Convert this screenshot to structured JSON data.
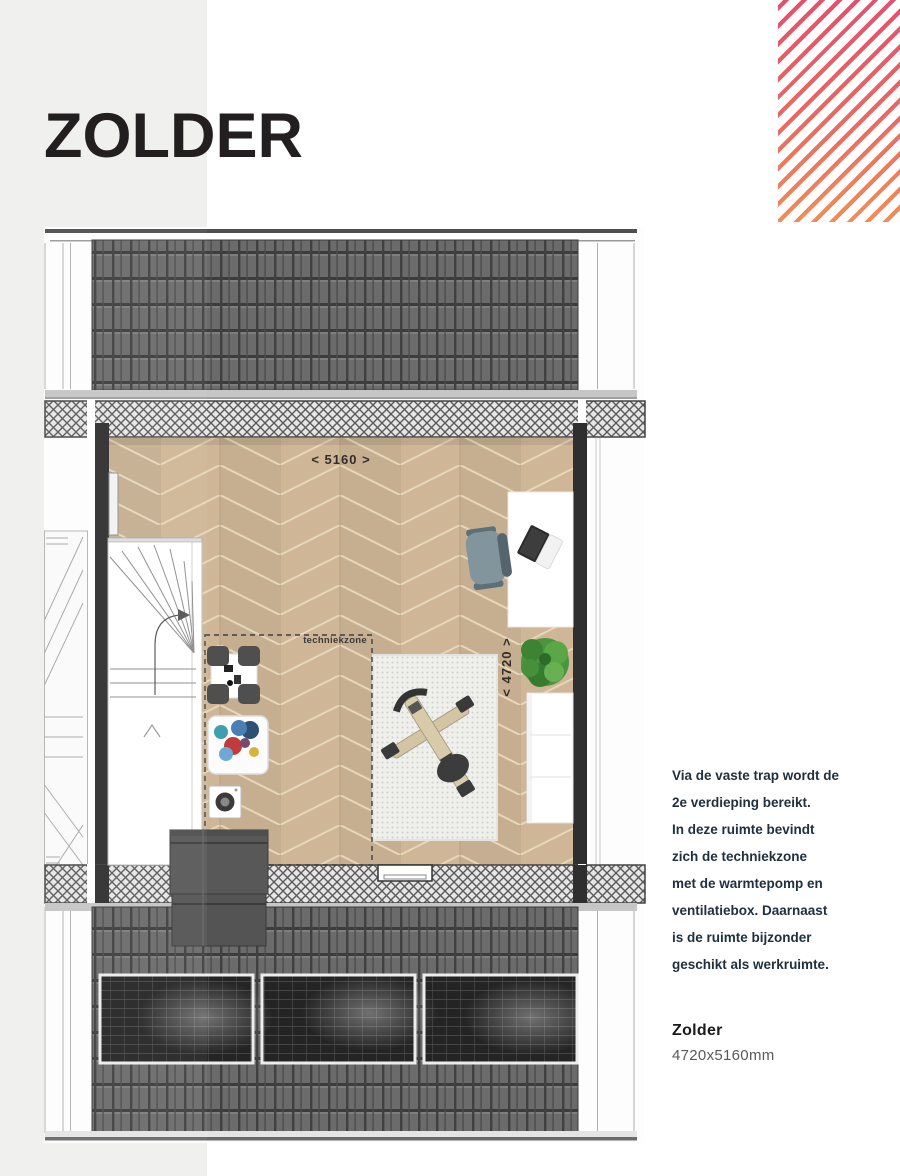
{
  "header": {
    "title": "ZOLDER"
  },
  "plan": {
    "width_label": "< 5160 >",
    "depth_label": "< 4720 >",
    "zone_label": "techniekzone"
  },
  "sidebar": {
    "description_lines": [
      "Via de vaste trap wordt de",
      "2e verdieping bereikt.",
      "In deze ruimte bevindt",
      "zich de techniekzone",
      "met de warmtepomp en",
      "ventilatiebox. Daarnaast",
      "is de ruimte bijzonder",
      "geschikt als werkruimte."
    ],
    "room_name": "Zolder",
    "room_dimensions": "4720x5160mm"
  },
  "colors": {
    "accent_gradient_top": "#e4506c",
    "accent_gradient_bottom": "#f08d58",
    "text_dark": "#20303f",
    "text_gray": "#58595b",
    "floor_wood": "#cfb697",
    "roof_tile": "#6b6b6b",
    "wall_black": "#2f2f2f",
    "page_gray_column": "#f0f0ef"
  }
}
